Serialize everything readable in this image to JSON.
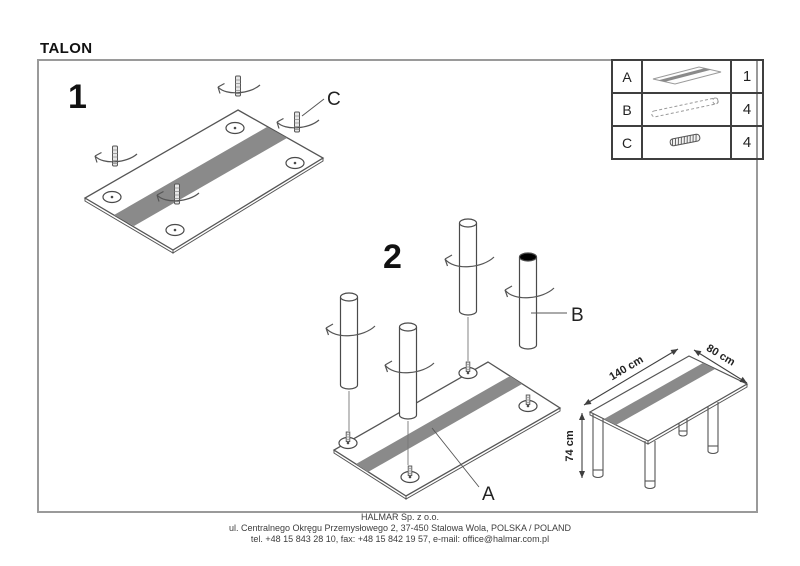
{
  "title": "TALON",
  "step1": {
    "number": "1",
    "screw_label": "C"
  },
  "step2": {
    "number": "2",
    "leg_label": "B",
    "top_label": "A"
  },
  "parts_table": {
    "rows": [
      {
        "letter": "A",
        "icon": "tabletop-icon",
        "qty": "1"
      },
      {
        "letter": "B",
        "icon": "leg-icon",
        "qty": "4"
      },
      {
        "letter": "C",
        "icon": "screw-icon",
        "qty": "4"
      }
    ]
  },
  "final_view": {
    "length_label": "140 cm",
    "depth_label": "80 cm",
    "height_label": "74 cm"
  },
  "footer": {
    "line1": "HALMAR Sp. z o.o.",
    "line2": "ul. Centralnego Okręgu Przemysłowego 2, 37-450 Stalowa Wola, POLSKA / POLAND",
    "line3": "tel. +48 15 843 28 10, fax: +48 15 842 19 57, e-mail: office@halmar.com.pl"
  },
  "colors": {
    "stripe": "#8a8a8a",
    "line": "#4a4a4a",
    "border": "#9a9a9a"
  }
}
